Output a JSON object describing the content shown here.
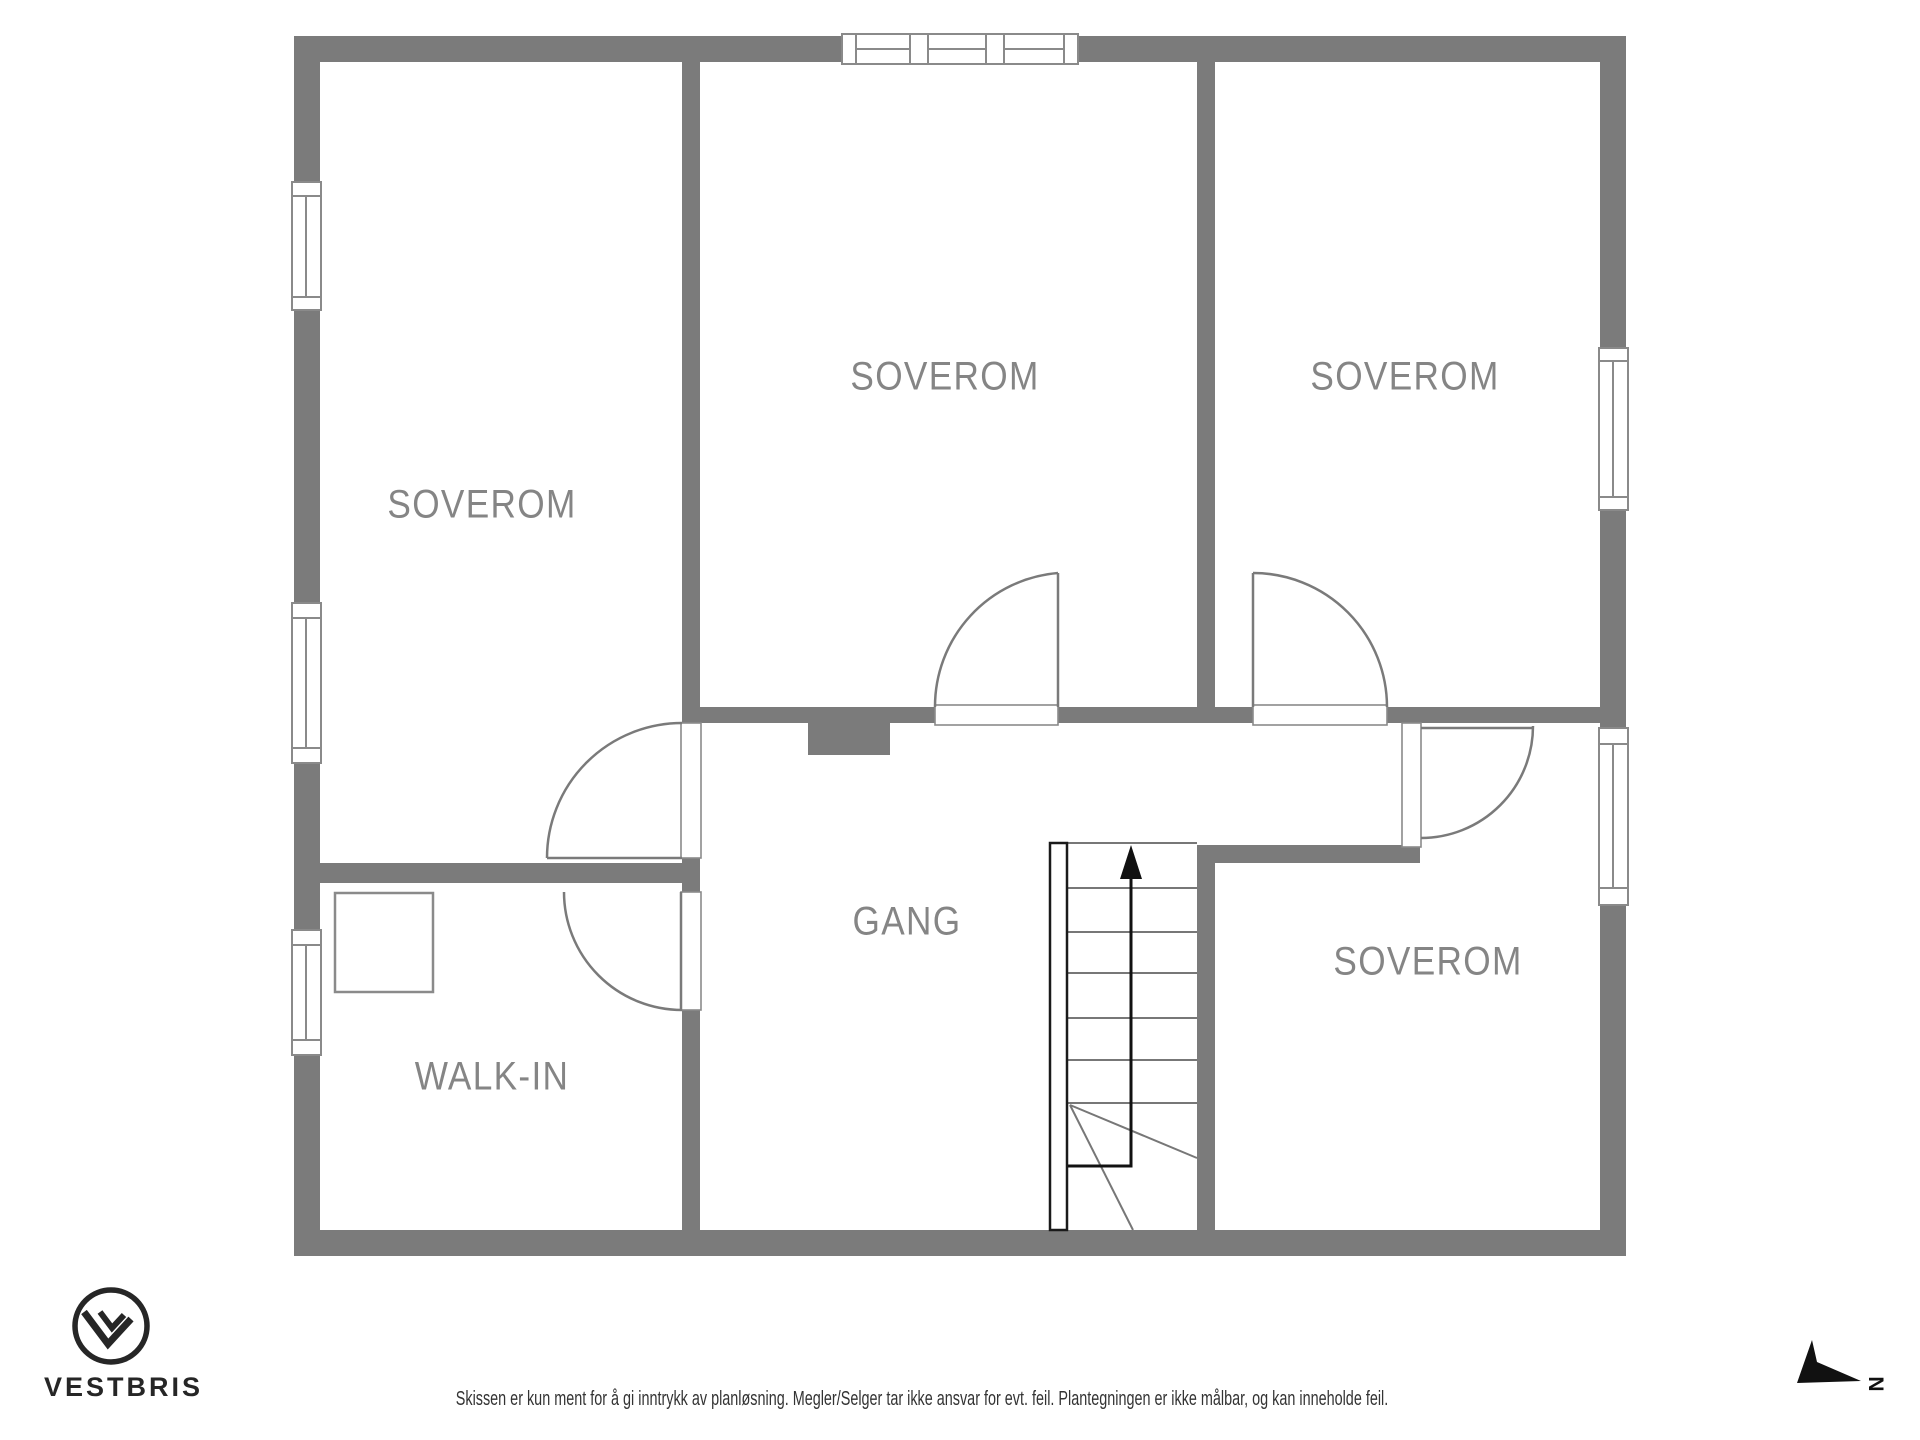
{
  "plan": {
    "rooms": [
      {
        "id": "soverom-top-left",
        "label": "SOVEROM",
        "cx": 482,
        "cy": 505
      },
      {
        "id": "soverom-top-middle",
        "label": "SOVEROM",
        "cx": 945,
        "cy": 377
      },
      {
        "id": "soverom-top-right",
        "label": "SOVEROM",
        "cx": 1405,
        "cy": 377
      },
      {
        "id": "gang",
        "label": "GANG",
        "cx": 907,
        "cy": 922
      },
      {
        "id": "walk-in",
        "label": "WALK-IN",
        "cx": 492,
        "cy": 1077
      },
      {
        "id": "soverom-bottom-right",
        "label": "SOVEROM",
        "cx": 1428,
        "cy": 962
      }
    ],
    "north_marker": {
      "letter": "N"
    },
    "colors": {
      "wall": "#7b7b7b",
      "thin_line": "#8a8a8a",
      "door_line": "#7a7a7a",
      "stair_line": "#777777",
      "ink": "#111111",
      "logo": "#262626",
      "label": "#858585"
    }
  },
  "footer": {
    "brand": "VESTBRIS",
    "disclaimer": "Skissen er kun ment for å gi inntrykk av planløsning. Megler/Selger tar ikke ansvar for evt. feil. Plantegningen er ikke målbar, og kan inneholde feil."
  }
}
